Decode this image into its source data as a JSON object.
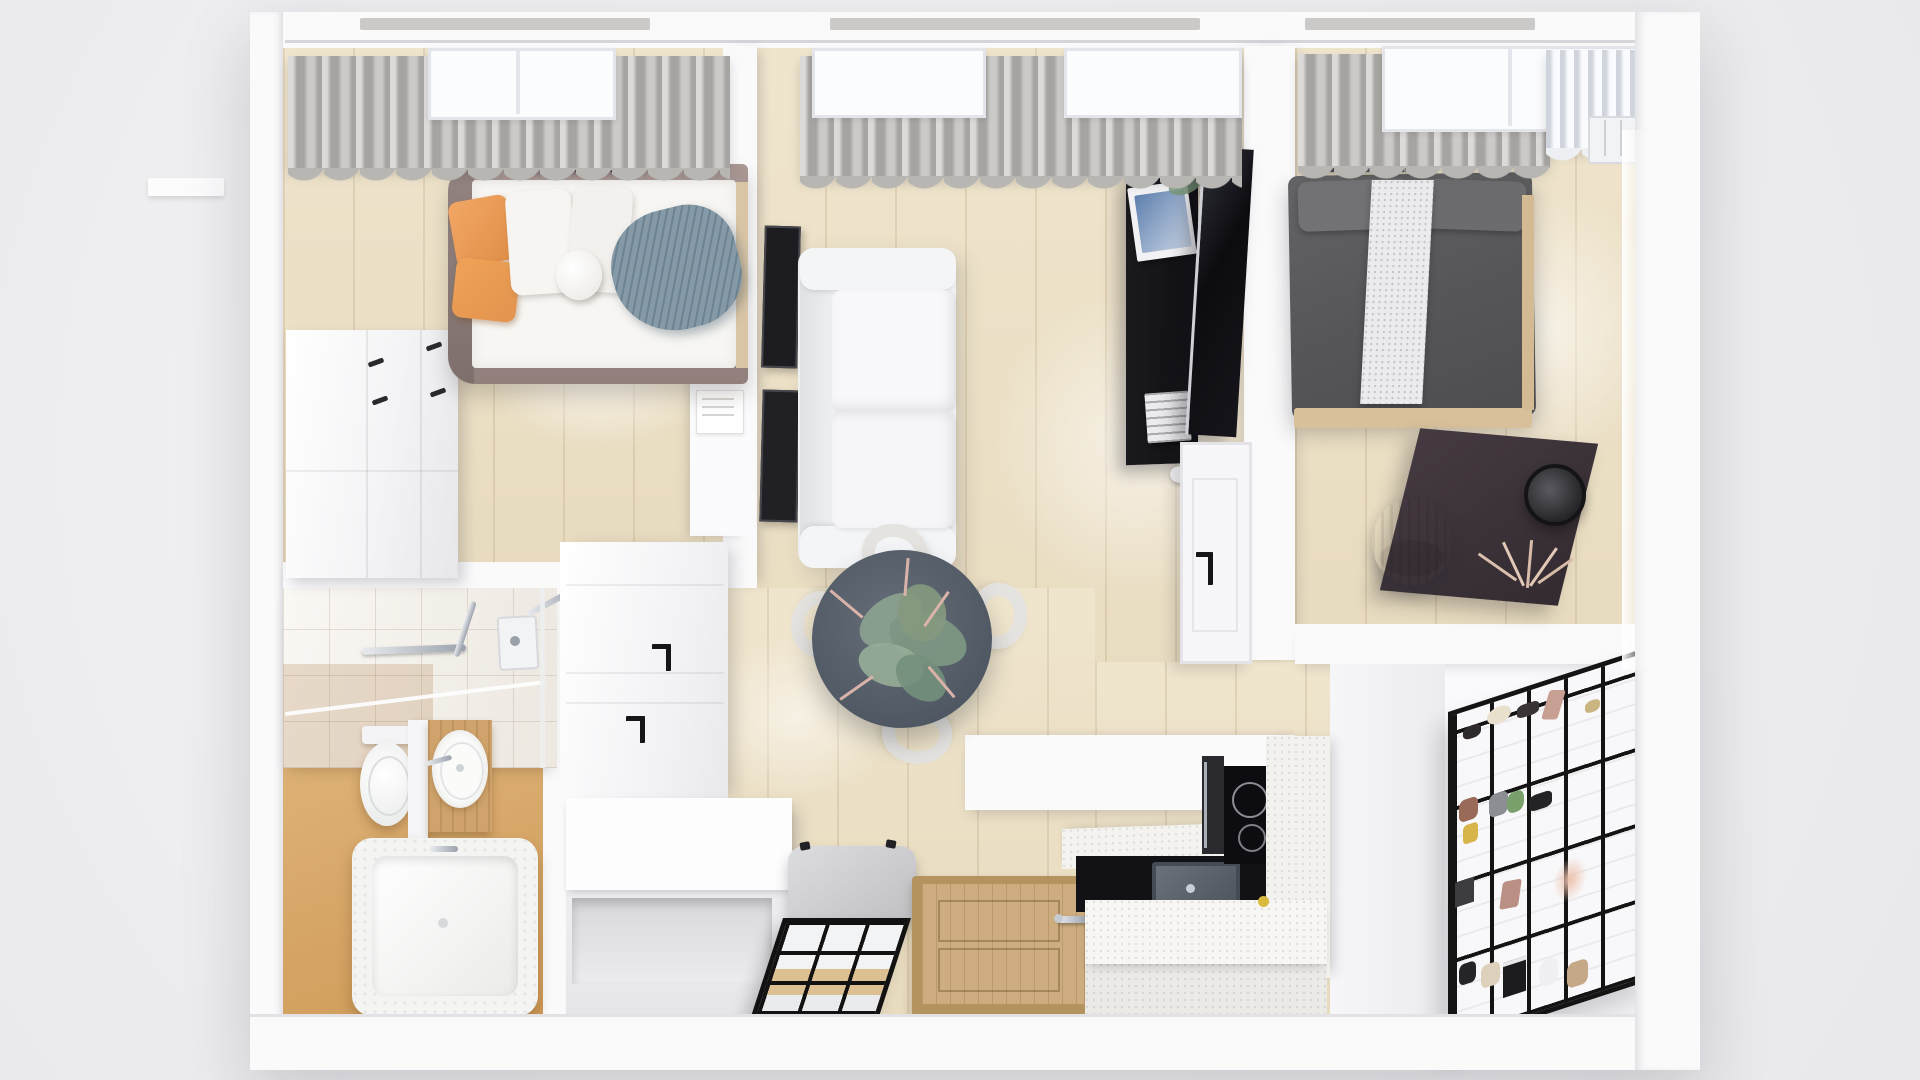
{
  "scene": {
    "title": "Top-down 3D render of a compact apartment floor plan",
    "view": "top-down isometric architectural render",
    "canvas": {
      "width": 1920,
      "height": 1080
    },
    "palette": {
      "background": "#f0f0f1",
      "wall": "#fafafb",
      "wood_floor": "#ecdfc2",
      "bath_floor_tan": "#d8a765",
      "curtain_gray": "#b8b6b3",
      "curtain_white": "#edeff2",
      "pillow_orange": "#efa25f",
      "throw_blue": "#8599a6",
      "sofa_white": "#f2f2f4",
      "dining_table_slate": "#545d68",
      "plant_green": "#84997f",
      "media_unit_black": "#141418",
      "bed2_charcoal": "#58585a",
      "desk_dark_wood": "#3a3138",
      "vanity_wood": "#cfa36b",
      "entry_door_wood": "#cdad7f",
      "partition_grid_black": "#141414",
      "island_quartz": "#f5f4f0"
    }
  },
  "rooms": [
    {
      "id": "bedroom-1",
      "name": "Bedroom 1 (top left)",
      "items": [
        "gray curtain with skylight window",
        "ceiling vent grille",
        "upholstered bed with white duvet",
        "two orange pillows",
        "white pillows and knot cushion",
        "blue knit throw",
        "white dresser with black handles",
        "white desk with paper sheet"
      ]
    },
    {
      "id": "living-room",
      "name": "Living room (center)",
      "items": [
        "gray curtains with two skylight windows",
        "two dark art frames on wall",
        "white two-seat sofa",
        "round slate dining table",
        "eucalyptus and blossom centerpiece",
        "four boucle dining chairs",
        "black media cabinet with magazines, plant sprig, books and remote",
        "wall mounted TV",
        "white interior door with black handle"
      ]
    },
    {
      "id": "bedroom-2",
      "name": "Bedroom 2 (top right)",
      "items": [
        "gray curtain",
        "white sheer curtain",
        "window radiator",
        "ceiling vent grille",
        "charcoal double bed with gray pillows",
        "white knit bed runner",
        "wood bed frame edge",
        "dark vanity desk",
        "round black-rim mirror",
        "gray cylinder chair",
        "dried pampas decor"
      ]
    },
    {
      "id": "bathroom",
      "name": "Bathroom (bottom left)",
      "items": [
        "white tiled shower wall",
        "chrome shower bar, mixer and head",
        "glass shower screen",
        "toilet",
        "partition wall",
        "wood vanity with round basin and faucet",
        "bathtub with hex-tile deck"
      ]
    },
    {
      "id": "hallway",
      "name": "Entry hall (bottom center)",
      "items": [
        "white wardrobe block with two black hook handles",
        "white storage bench with open shelf",
        "gray floor cushion",
        "leaning mirror with black grid frame",
        "wooden entry door with chrome handle",
        "dark cabinet side panel"
      ]
    },
    {
      "id": "kitchen",
      "name": "Kitchen (bottom right)",
      "items": [
        "white quartz upper counter",
        "black countertop",
        "stainless steel sink",
        "induction cooktop with two burners",
        "built-in oven",
        "quartz island",
        "tall cabinet counter",
        "lemon"
      ]
    },
    {
      "id": "walk-in-closet",
      "name": "Walk-in closet (bottom right corner)",
      "items": [
        "black framed glass grid partition",
        "white shelves",
        "shoes",
        "handbags",
        "books",
        "small plant",
        "white jug"
      ]
    }
  ]
}
